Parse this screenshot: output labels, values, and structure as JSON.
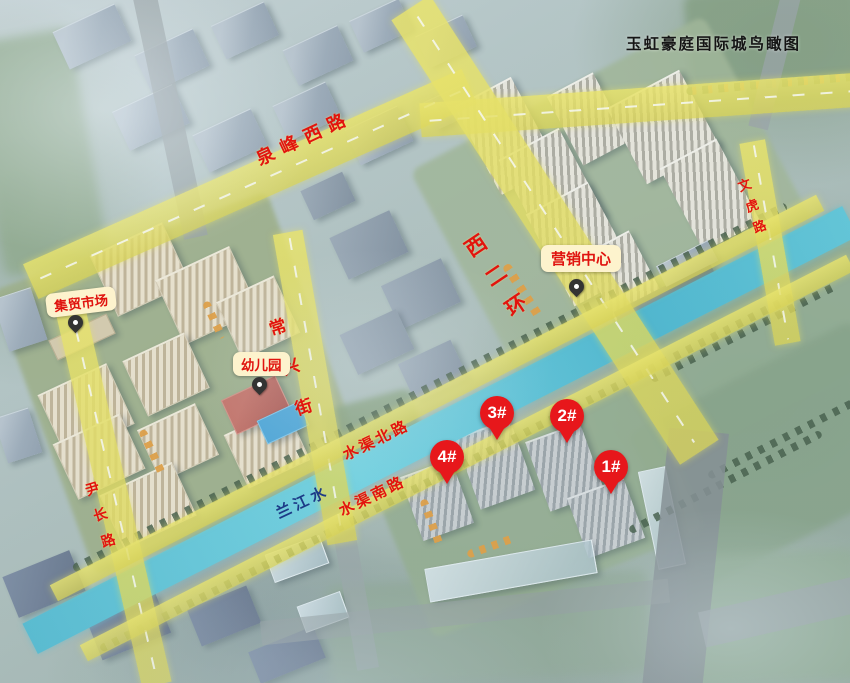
{
  "title": "玉虹豪庭国际城鸟瞰图",
  "roads": {
    "quanfeng_west": "泉峰西路",
    "west_second_ring": "西二环",
    "changxing_street": "常兴街",
    "yinchang_road": "尹长路",
    "wenhu_road": "文虎路",
    "shuiqu_north": "水渠北路",
    "shuiqu_south": "水渠南路",
    "lanjiang_water": "兰江水"
  },
  "pois": {
    "market": "集贸市场",
    "kindergarten": "幼儿园",
    "sales_center": "营销中心"
  },
  "building_pins": [
    {
      "label": "4#"
    },
    {
      "label": "3#"
    },
    {
      "label": "2#"
    },
    {
      "label": "1#"
    }
  ],
  "colors": {
    "highlight_road_yellow": "#e9e155",
    "river_cyan": "#3fb8d0",
    "road_label_red": "#e2140e",
    "poi_pill_bg": "#fdf3cd",
    "poi_pill_text": "#e0140f",
    "pin_red": "#e7171b",
    "pin_text": "#ffffff",
    "river_label_blue": "#1c3a86",
    "title_text": "#151515"
  }
}
